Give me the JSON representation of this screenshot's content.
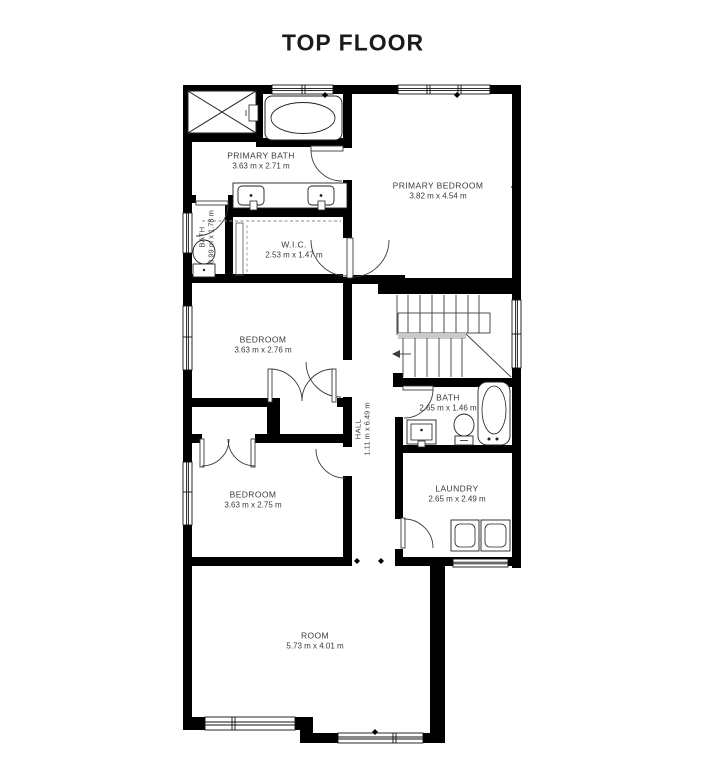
{
  "title": "TOP FLOOR",
  "rooms": {
    "primary_bath": {
      "name": "PRIMARY BATH",
      "dims": "3.63 m x 2.71 m"
    },
    "primary_bedroom": {
      "name": "PRIMARY BEDROOM",
      "dims": "3.82 m x 4.54 m"
    },
    "bath_small": {
      "name": "BATH",
      "dims": "0.99 m x 1.78 m"
    },
    "wic": {
      "name": "W.I.C.",
      "dims": "2.53 m x 1.47 m"
    },
    "bedroom_1": {
      "name": "BEDROOM",
      "dims": "3.63 m x 2.76 m"
    },
    "hall": {
      "name": "HALL",
      "dims": "1.11 m x 6.49 m"
    },
    "bath": {
      "name": "BATH",
      "dims": "2.65 m x 1.46 m"
    },
    "bedroom_2": {
      "name": "BEDROOM",
      "dims": "3.63 m x 2.75 m"
    },
    "laundry": {
      "name": "LAUNDRY",
      "dims": "2.65 m x 2.49 m"
    },
    "room": {
      "name": "ROOM",
      "dims": "5.73 m x 4.01 m"
    }
  },
  "fixtures": [
    "shower-icon",
    "bathtub-icon",
    "sink-icon",
    "toilet-icon",
    "washer-icon",
    "dryer-icon",
    "stairs-icon",
    "door-swing-icon",
    "window-icon",
    "closet-rod-icon",
    "stair-direction-arrow-icon"
  ],
  "colors": {
    "wall": "#000000",
    "background": "#ffffff",
    "text": "#3a3a3a",
    "fixture_line": "#3c3c3c",
    "stair_highlight": "#c9c9c9",
    "dashed_line": "#8a8a8a"
  }
}
